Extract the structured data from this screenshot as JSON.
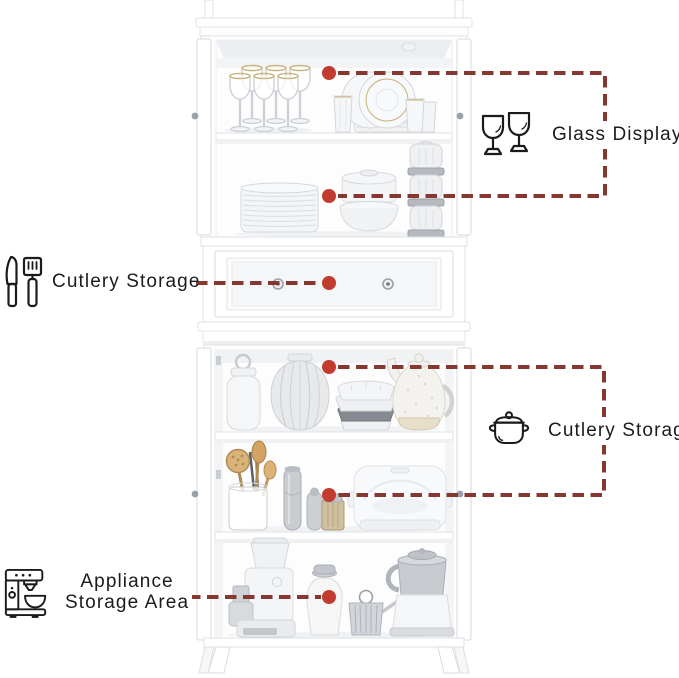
{
  "page": {
    "background": "#ffffff",
    "subject": "Tall white kitchen hutch cabinet with open doors showing dishware, drawer and appliances, annotated with feature callouts"
  },
  "colors": {
    "leader_line": "#863830",
    "marker_dot": "#c13b2e",
    "label_text": "#1b1b1b",
    "cabinet_white": "#ffffff"
  },
  "annotations": {
    "glass_display": {
      "label": "Glass Display",
      "icon": "wine-glasses-icon",
      "side": "right"
    },
    "cutlery_drawer": {
      "label": "Cutlery Storage",
      "icon": "knife-spatula-icon",
      "side": "left"
    },
    "cutlery_cabinet": {
      "label": "Cutlery Storage",
      "icon": "cooking-pot-icon",
      "side": "right"
    },
    "appliance_area": {
      "line1": "Appliance",
      "line2": "Storage Area",
      "icon": "espresso-machine-icon",
      "side": "left"
    }
  },
  "cabinet_sections": [
    {
      "name": "upper-display-shelf",
      "items": [
        "wine glasses",
        "dinner plates",
        "tumblers"
      ]
    },
    {
      "name": "upper-lower-shelf",
      "items": [
        "plate stack",
        "food containers",
        "stacked glass jars"
      ]
    },
    {
      "name": "cutlery-drawer",
      "items": [
        "drawer with two knobs"
      ]
    },
    {
      "name": "middle-shelf",
      "items": [
        "lidded canister",
        "patterned vase",
        "bowl stack",
        "speckled teapot"
      ]
    },
    {
      "name": "lower-middle-shelf",
      "items": [
        "utensil jar",
        "pepper mills",
        "small canister",
        "steamer"
      ]
    },
    {
      "name": "appliance-shelf",
      "items": [
        "coffee grinder",
        "pitcher",
        "wire basket",
        "milk frother"
      ]
    }
  ]
}
